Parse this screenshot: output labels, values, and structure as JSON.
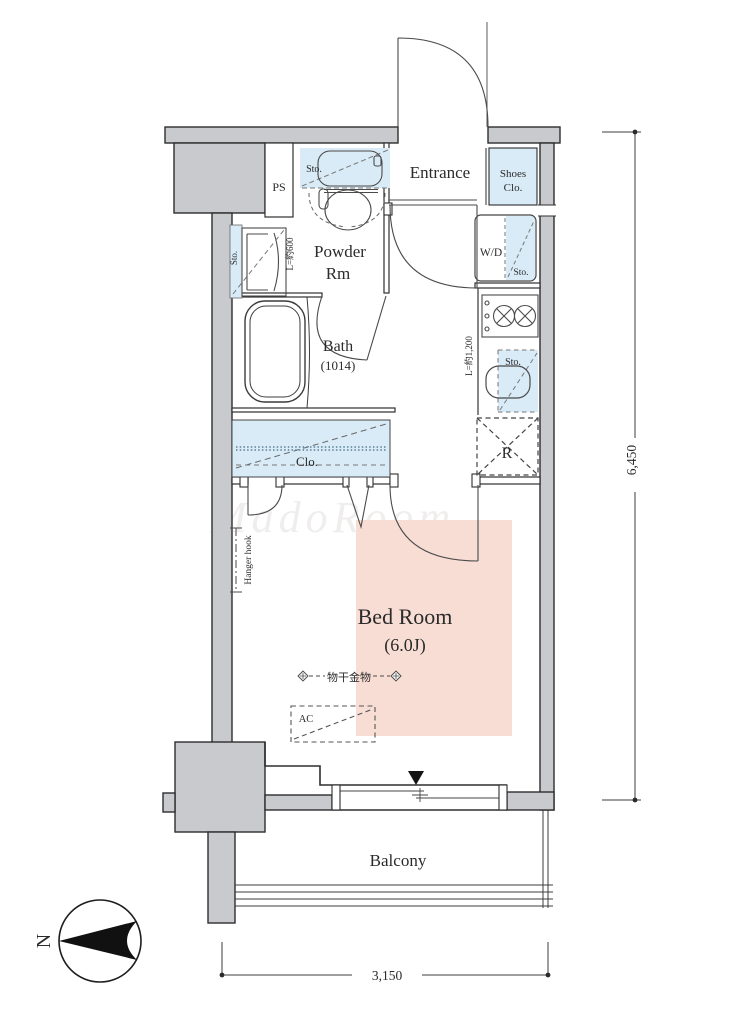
{
  "plan": {
    "title": "apartment-floor-plan",
    "labels": {
      "entrance": "Entrance",
      "shoes_line1": "Shoes",
      "shoes_line2": "Clo.",
      "pipe_space": "PS",
      "toilet_storage": "Sto.",
      "powder_line1": "Powder",
      "powder_line2": "Rm",
      "washer_storage": "Sto.",
      "washer_width": "L=約600",
      "bath": "Bath",
      "bath_size": "(1014)",
      "washer_dryer": "W/D",
      "wd_storage": "Sto.",
      "kitchen_width": "L=約1,200",
      "kitchen_storage": "Sto.",
      "refrigerator": "R",
      "closet": "Clo.",
      "bedroom": "Bed Room",
      "bedroom_size": "(6.0J)",
      "laundry_fixture": "物干金物",
      "ac_unit": "AC",
      "hanger_hook": "Hanger hook",
      "balcony": "Balcony"
    },
    "dimensions": {
      "vertical": "6,450",
      "horizontal": "3,150"
    },
    "compass": {
      "north": "N"
    },
    "watermark": "MadoRoom",
    "colors": {
      "storage_fill": "#d9ebf7",
      "bedroom_fill": "#f8ddd4",
      "wall_fill": "#c9cacd",
      "line": "#2e2e2e"
    }
  }
}
